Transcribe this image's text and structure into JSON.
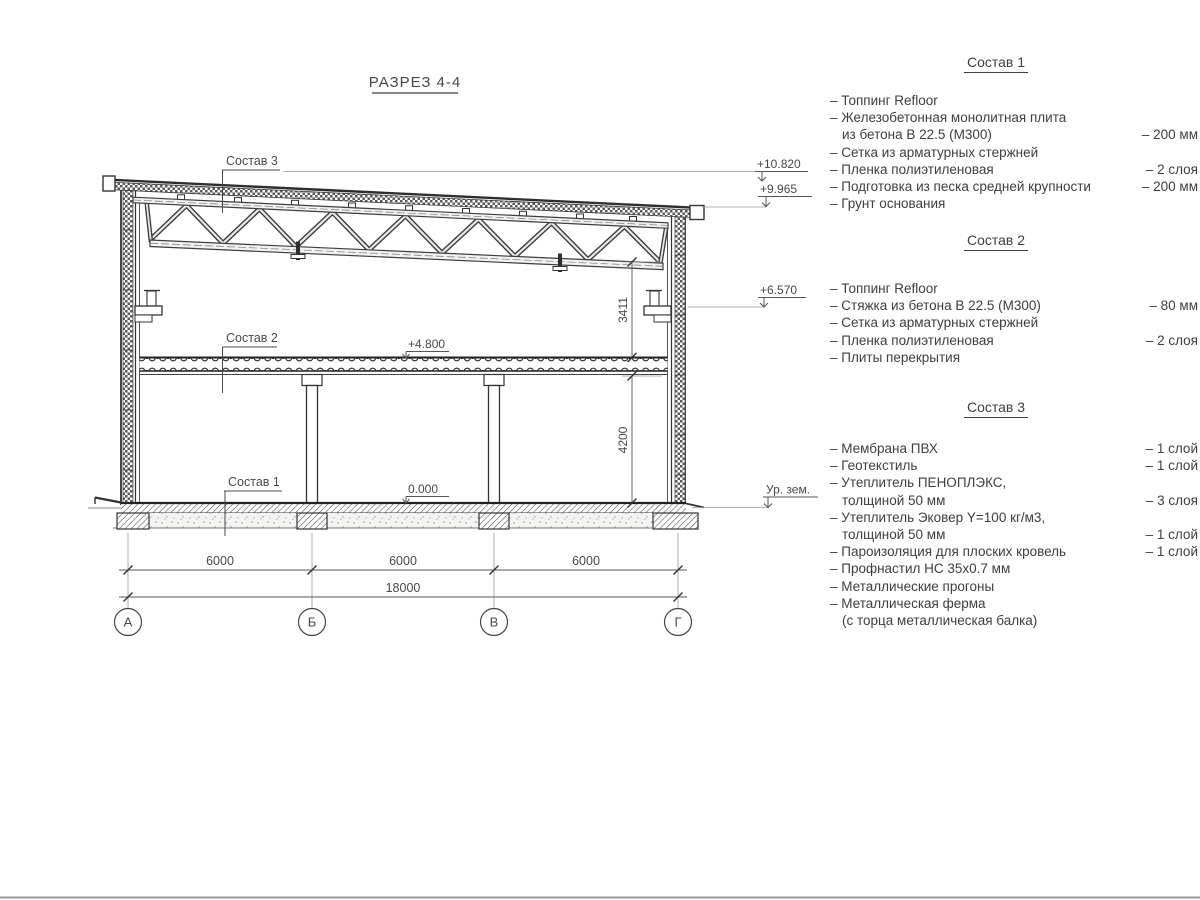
{
  "sheet": {
    "title": "РАЗРЕЗ 4-4"
  },
  "drawing": {
    "labels": {
      "sostav1": "Состав 1",
      "sostav2": "Состав 2",
      "sostav3": "Состав 3"
    },
    "elevations": {
      "roof_high": "+10.820",
      "roof_low": "+9.965",
      "crane_beam": "+6.570",
      "second_floor": "+4.800",
      "ground_floor": "0.000",
      "ground_level": "Ур. зем."
    },
    "dimensions": {
      "truss_to_floor": "3411",
      "floor_height": "4200",
      "bay": "6000",
      "total": "18000"
    },
    "axes": [
      "А",
      "Б",
      "В",
      "Г"
    ]
  },
  "compositions": [
    {
      "title": "Состав 1",
      "rows": [
        {
          "l": "– Топпинг Refloor",
          "r": ""
        },
        {
          "l": "– Железобетонная монолитная плита",
          "r": ""
        },
        {
          "l": "из бетона В 22.5 (М300)",
          "r": "– 200 мм"
        },
        {
          "l": "– Сетка из арматурных стержней",
          "r": ""
        },
        {
          "l": "– Пленка полиэтиленовая",
          "r": "– 2 слоя"
        },
        {
          "l": "– Подготовка из песка средней крупности",
          "r": "– 200 мм"
        },
        {
          "l": "– Грунт основания",
          "r": ""
        }
      ]
    },
    {
      "title": "Состав 2",
      "rows": [
        {
          "l": "– Топпинг Refloor",
          "r": ""
        },
        {
          "l": "– Стяжка из бетона В 22.5 (М300)",
          "r": "– 80 мм"
        },
        {
          "l": "– Сетка из арматурных стержней",
          "r": ""
        },
        {
          "l": "– Пленка полиэтиленовая",
          "r": "– 2 слоя"
        },
        {
          "l": "– Плиты перекрытия",
          "r": ""
        }
      ]
    },
    {
      "title": "Состав 3",
      "rows": [
        {
          "l": "– Мембрана ПВХ",
          "r": "– 1 слой"
        },
        {
          "l": "– Геотекстиль",
          "r": "– 1 слой"
        },
        {
          "l": "– Утеплитель ПЕНОПЛЭКС,",
          "r": ""
        },
        {
          "l": "толщиной 50 мм",
          "r": "– 3 слоя"
        },
        {
          "l": "– Утеплитель Эковер Y=100 кг/м3,",
          "r": ""
        },
        {
          "l": "толщиной 50 мм",
          "r": "– 1 слой"
        },
        {
          "l": "– Пароизоляция для плоских кровель",
          "r": "– 1 слой"
        },
        {
          "l": "– Профнастил НС 35х0.7 мм",
          "r": ""
        },
        {
          "l": "– Металлические прогоны",
          "r": ""
        },
        {
          "l": "– Металлическая ферма",
          "r": ""
        },
        {
          "l": "(с торца металлическая балка)",
          "r": ""
        }
      ]
    }
  ]
}
